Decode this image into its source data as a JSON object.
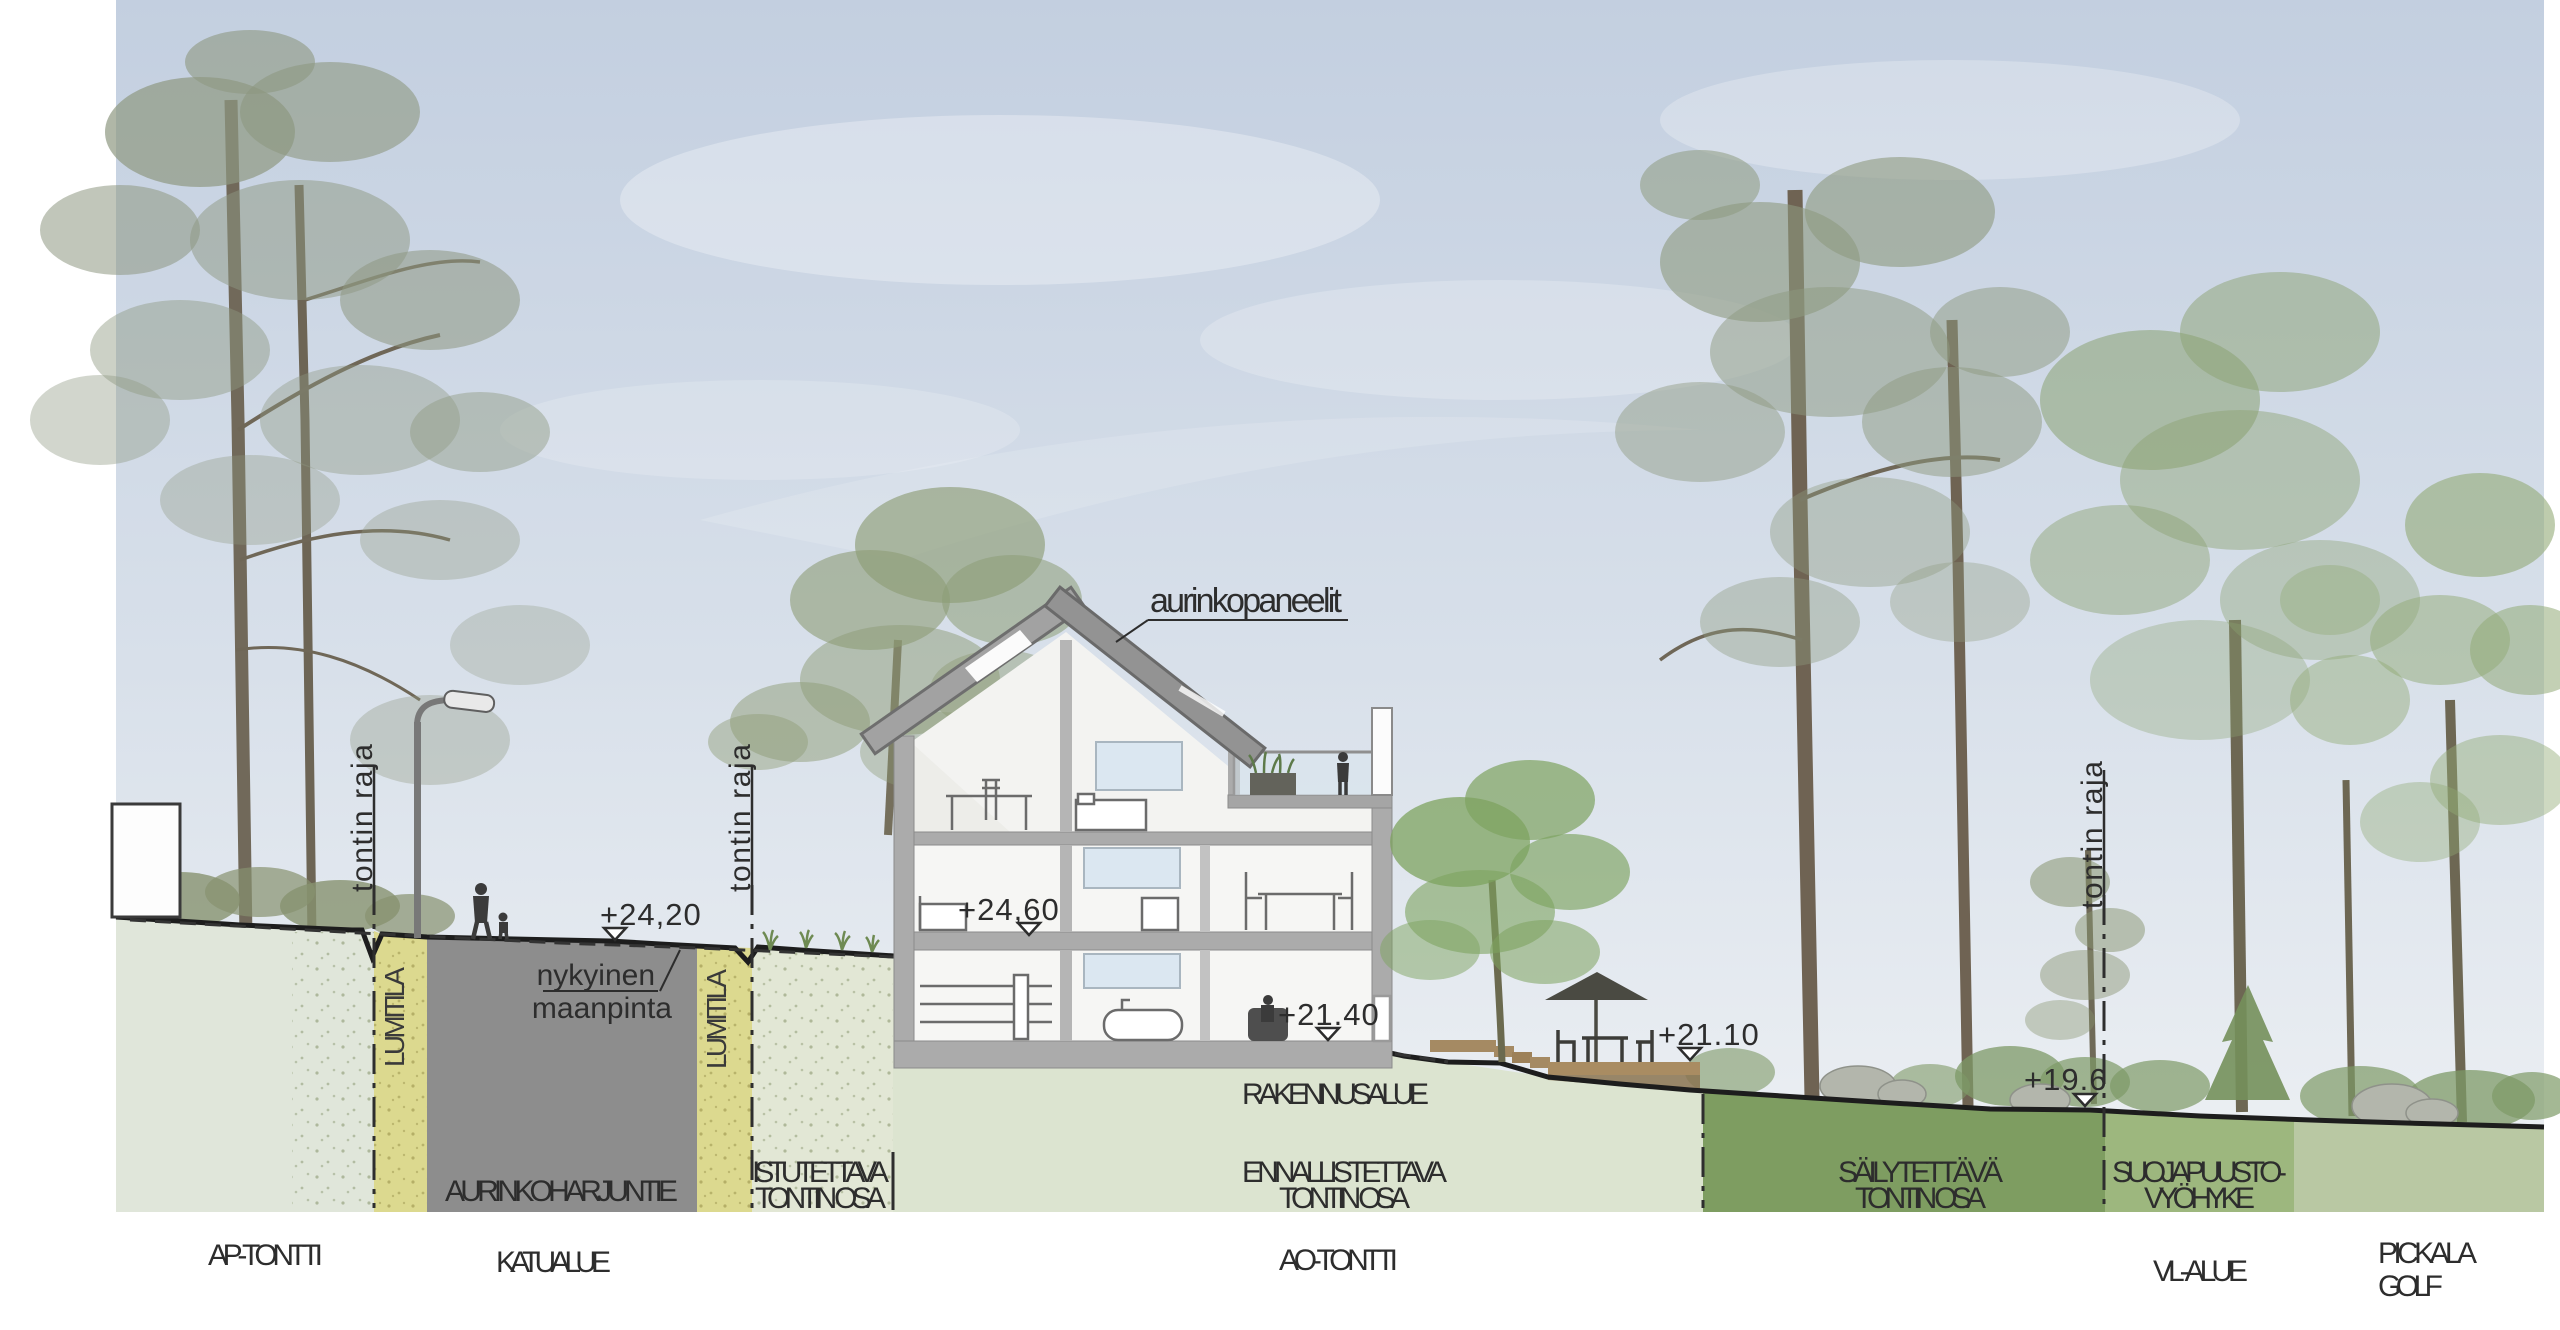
{
  "annotations": {
    "solar_panels": "aurinkopaneelit",
    "existing_ground_line1": "nykyinen",
    "existing_ground_line2": "maanpinta",
    "plot_boundary_left": "tontin raja",
    "plot_boundary_mid": "tontin raja",
    "plot_boundary_right": "tontin raja",
    "snow_space_left": "LUMITILA",
    "snow_space_right": "LUMITILA",
    "building_area": "RAKENNUSALUE"
  },
  "levels": {
    "street": "+24,20",
    "upper_floor": "+24,60",
    "main_floor": "+21.40",
    "yard": "+21.10",
    "forest_edge": "+19.6"
  },
  "zones": {
    "street_name": "AURINKOHARJUNTIE",
    "planted_line1": "ISTUTETTAVA",
    "planted_line2": "TONTIN OSA",
    "restored_line1": "ENNALLISTETTAVA",
    "restored_line2": "TONTIN OSA",
    "preserved_line1": "SÄILYTETTÄVÄ",
    "preserved_line2": "TONTIN OSA",
    "buffer_line1": "SUOJAPUUSTO-",
    "buffer_line2": "VYÖHYKE"
  },
  "areas": {
    "ap": "AP-TONTTI",
    "street": "KATUALUE",
    "ao": "AO-TONTTI",
    "vl": "VL-ALUE",
    "golf_line1": "PICKALA",
    "golf_line2": "GOLF"
  },
  "colors": {
    "sky_top": "#c3cfe0",
    "sky_bottom": "#eef1f4",
    "zone_ap": "#e0e6da",
    "zone_lumitila": "#dcd98f",
    "zone_road": "#8d8d8d",
    "zone_planted": "#e2e7d5",
    "zone_ao": "#dce4d0",
    "zone_preserved": "#7e9d61",
    "zone_buffer": "#9db77e",
    "zone_golf": "#b9c8a3",
    "ink": "#2d2d2d"
  }
}
